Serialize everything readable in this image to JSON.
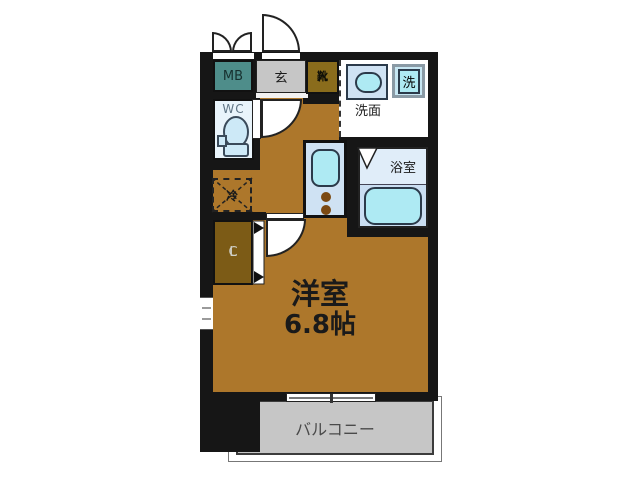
{
  "colors": {
    "wall": "#161616",
    "floor": "#ad772b",
    "meterbox": "#4e8d8a",
    "entry": "#c6c6c6",
    "shoe": "#8a6c1c",
    "closet": "#7c5b16",
    "wcfloor": "#e9f4fb",
    "fixture": "#aeeaf3",
    "counter": "#cfe2f3",
    "bathupper": "#e0edf9",
    "bathlower": "#cadef2",
    "balcony": "#c6c6c6"
  },
  "rooms": {
    "meter_box": "MB",
    "entry": "玄",
    "shoe_cabinet": [
      "靴",
      "入"
    ],
    "wc": "WC",
    "washroom": "洗面",
    "washing_machine": "洗",
    "refrigerator": "冷",
    "bathroom": "浴室",
    "closet": [
      "C",
      "L"
    ],
    "main_room": "洋室",
    "main_room_size": "6.8帖",
    "balcony": "バルコニー"
  }
}
